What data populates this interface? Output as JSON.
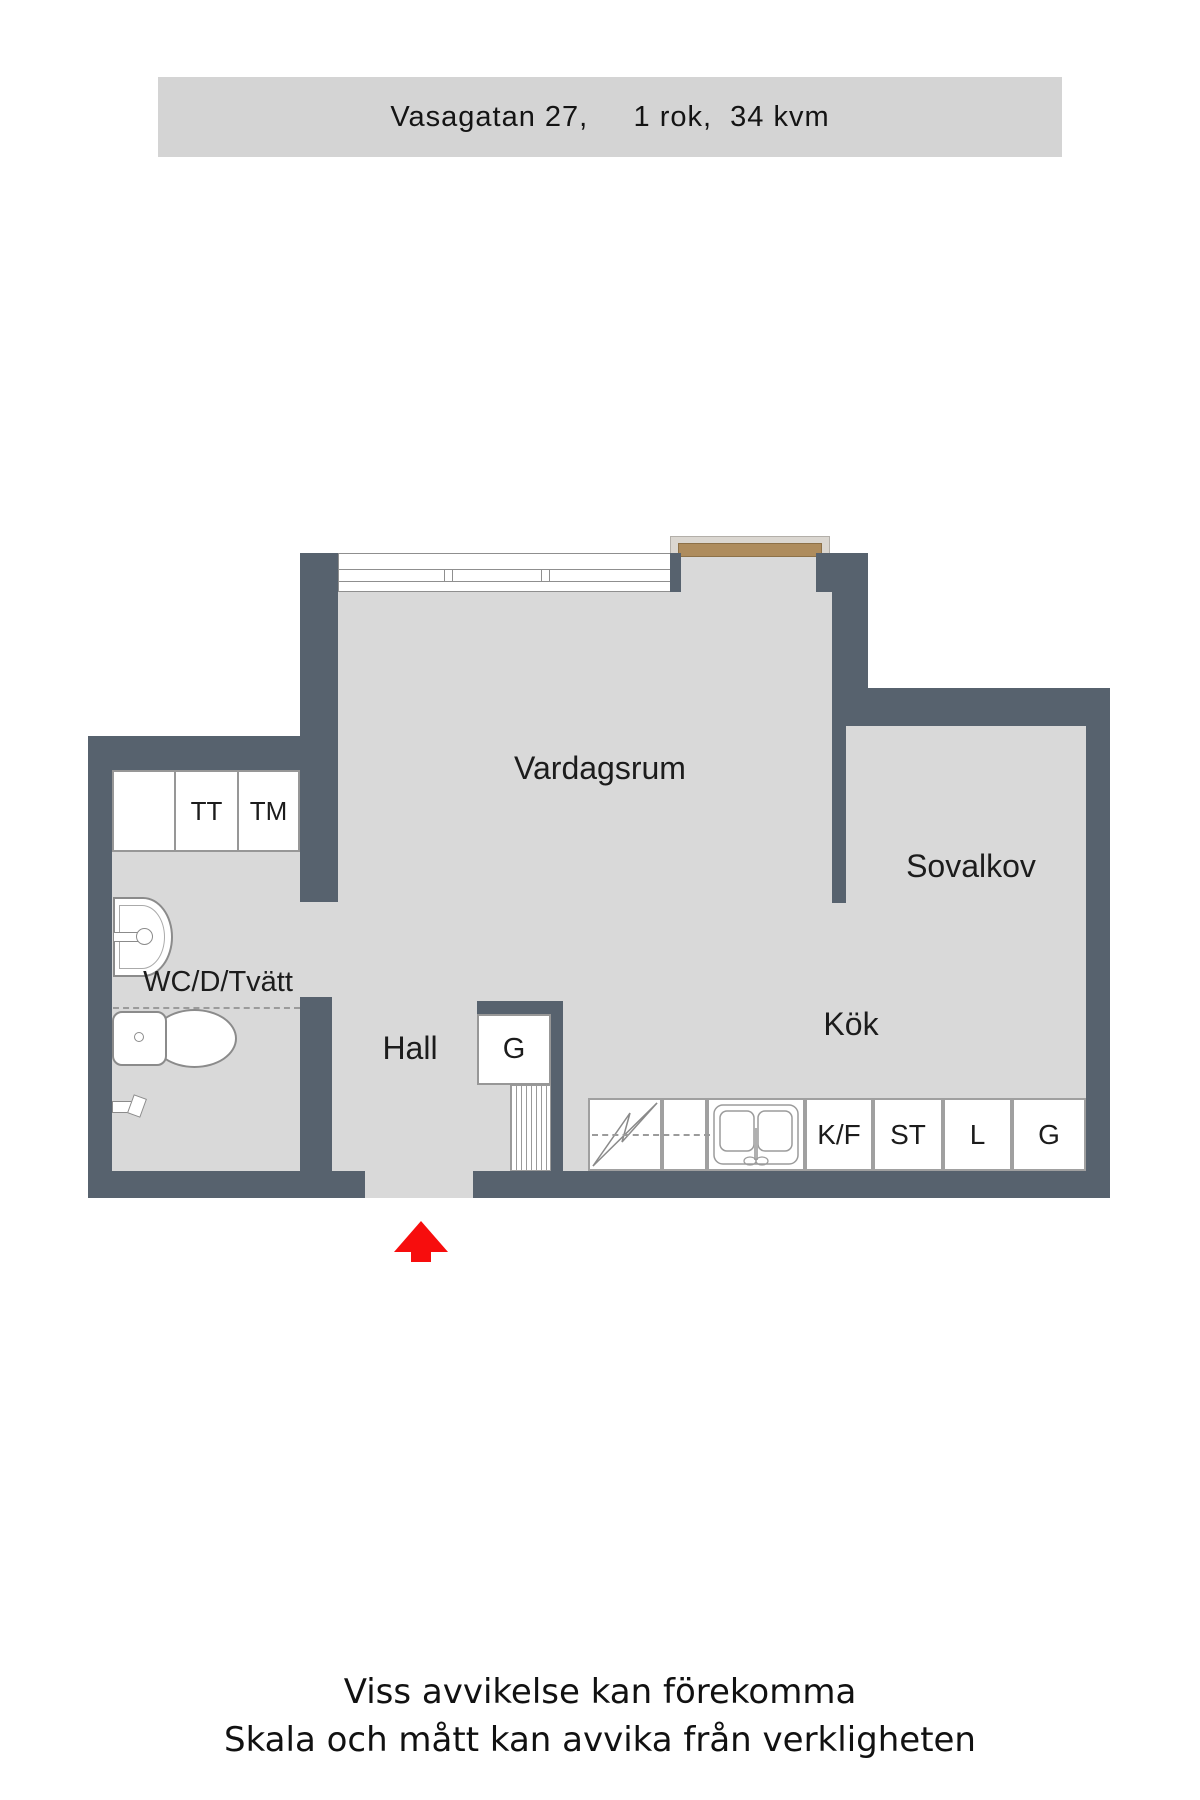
{
  "header": {
    "title": "Vasagatan 27,     1 rok,  34 kvm"
  },
  "floorplan": {
    "rooms": {
      "vardagsrum": "Vardagsrum",
      "sovalkov": "Sovalkov",
      "kok": "Kök",
      "hall": "Hall",
      "wc": "WC/D/Tvätt"
    },
    "cabinets": {
      "tt": "TT",
      "tm": "TM"
    },
    "hall_closet": {
      "g": "G"
    },
    "kitchen_units": {
      "kf": "K/F",
      "st": "ST",
      "l": "L",
      "g": "G"
    },
    "colors": {
      "wall": "#57626e",
      "floor": "#d9d9d9",
      "balcony_door": "#ae8c5d",
      "entrance_arrow": "#f70d0d",
      "header_bg": "#d4d4d4"
    }
  },
  "footer": {
    "line1": "Viss avvikelse kan förekomma",
    "line2": "Skala och mått kan avvika från verkligheten"
  }
}
